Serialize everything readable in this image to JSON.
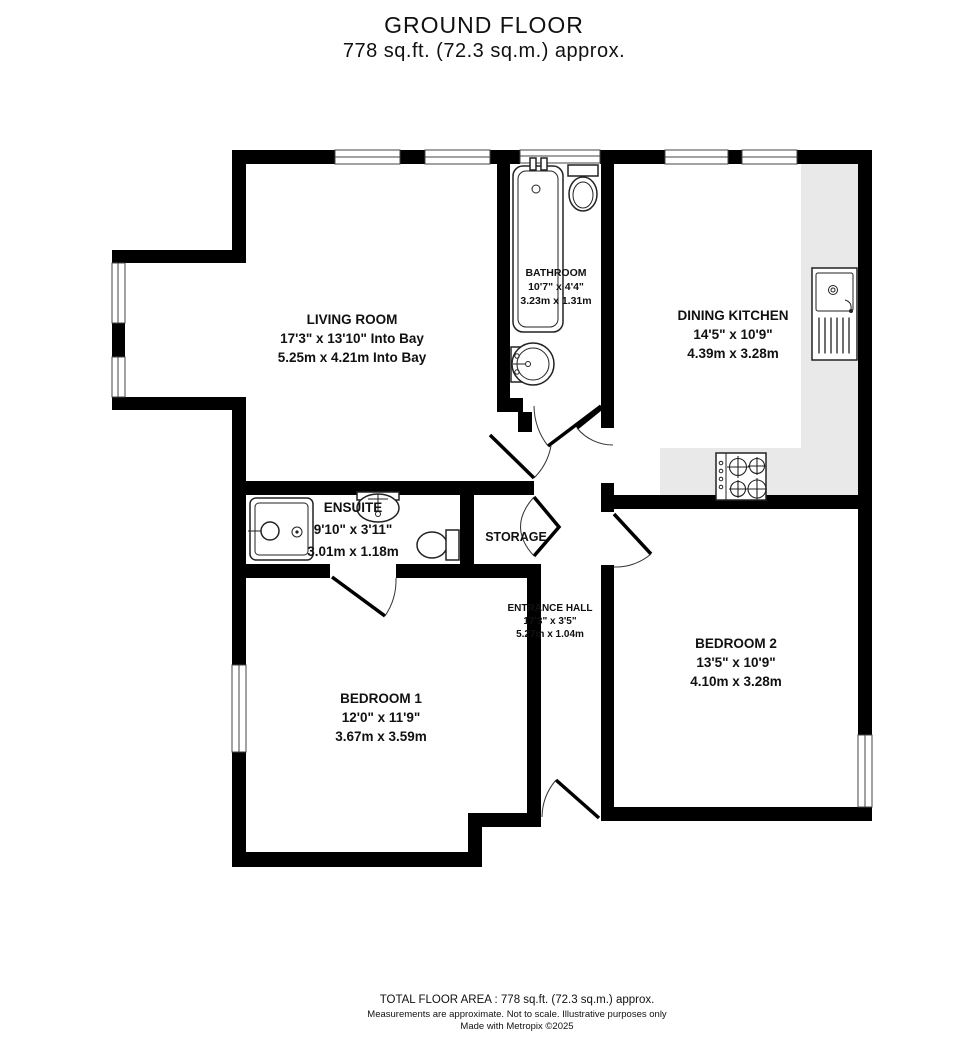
{
  "title": {
    "line1": "GROUND FLOOR",
    "line2": "778 sq.ft. (72.3 sq.m.) approx."
  },
  "rooms": {
    "living_room": {
      "name": "LIVING ROOM",
      "imperial": "17'3\"  x 13'10\" Into Bay",
      "metric": "5.25m  x 4.21m Into Bay"
    },
    "bathroom": {
      "name": "BATHROOM",
      "imperial": "10'7\"  x 4'4\"",
      "metric": "3.23m  x 1.31m"
    },
    "dining_kitchen": {
      "name": "DINING KITCHEN",
      "imperial": "14'5\"  x 10'9\"",
      "metric": "4.39m  x 3.28m"
    },
    "ensuite": {
      "name": "ENSUITE",
      "imperial": "9'10\"  x 3'11\"",
      "metric": "3.01m  x 1.18m"
    },
    "storage": {
      "name": "STORAGE"
    },
    "entrance_hall": {
      "name": "ENTRANCE HALL",
      "imperial": "17'3\"  x 3'5\"",
      "metric": "5.27m  x 1.04m"
    },
    "bedroom_1": {
      "name": "BEDROOM 1",
      "imperial": "12'0\"  x 11'9\"",
      "metric": "3.67m  x 3.59m"
    },
    "bedroom_2": {
      "name": "BEDROOM 2",
      "imperial": "13'5\"  x 10'9\"",
      "metric": "4.10m  x 3.28m"
    }
  },
  "footer": {
    "total": "TOTAL FLOOR AREA : 778 sq.ft. (72.3 sq.m.) approx.",
    "disclaimer": "Measurements are approximate.  Not to scale.  Illustrative purposes only",
    "credit": "Made with Metropix ©2025"
  },
  "colors": {
    "wall": "#000000",
    "counter": "#e9e9e9",
    "background": "#ffffff"
  }
}
